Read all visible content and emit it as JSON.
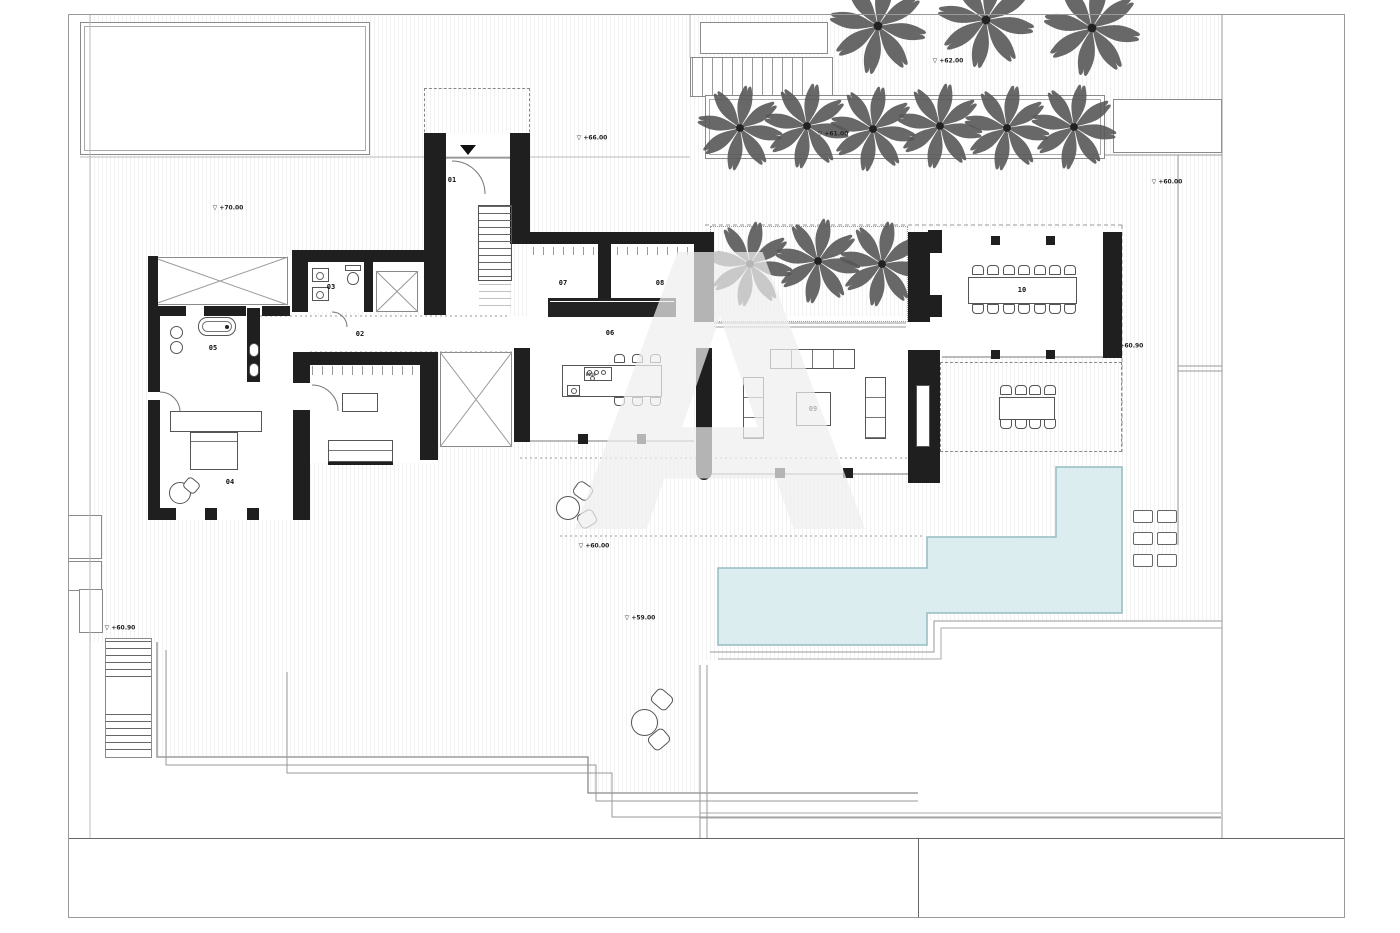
{
  "watermark": {
    "letter": "A"
  },
  "colors": {
    "wall": "#1f1f1f",
    "pool_fill": "#dbedef",
    "pool_edge": "#96bcc0",
    "line": "#8a8a8a"
  },
  "rooms": [
    {
      "number": "01",
      "area": "entry-stairs",
      "x": 452,
      "y": 180
    },
    {
      "number": "02",
      "area": "corridor",
      "x": 360,
      "y": 334
    },
    {
      "number": "03",
      "area": "wc",
      "x": 331,
      "y": 287
    },
    {
      "number": "04",
      "area": "bedroom",
      "x": 230,
      "y": 482
    },
    {
      "number": "05",
      "area": "bathroom",
      "x": 213,
      "y": 348
    },
    {
      "number": "06",
      "area": "kitchen",
      "x": 610,
      "y": 333
    },
    {
      "number": "07",
      "area": "storage-a",
      "x": 563,
      "y": 283
    },
    {
      "number": "08",
      "area": "storage-b",
      "x": 660,
      "y": 283
    },
    {
      "number": "09",
      "area": "living-room",
      "x": 813,
      "y": 409
    },
    {
      "number": "10",
      "area": "dining-room",
      "x": 1022,
      "y": 290
    }
  ],
  "elevation_markers": [
    {
      "text": "+70.00",
      "x": 228,
      "y": 208
    },
    {
      "text": "+66.00",
      "x": 592,
      "y": 138
    },
    {
      "text": "+62.00",
      "x": 948,
      "y": 61
    },
    {
      "text": "+61.00",
      "x": 833,
      "y": 134
    },
    {
      "text": "+60.00",
      "x": 1167,
      "y": 182
    },
    {
      "text": "+60.90",
      "x": 1128,
      "y": 346
    },
    {
      "text": "+60.00",
      "x": 594,
      "y": 546
    },
    {
      "text": "+59.00",
      "x": 640,
      "y": 618
    },
    {
      "text": "+60.90",
      "x": 120,
      "y": 628
    }
  ],
  "kitchen_island": {
    "label": "RO18"
  },
  "counts": {
    "dining_chairs": 14,
    "outdoor_dining_chairs": 8,
    "island_stools": 6,
    "sun_loungers": 6,
    "palms_top": 3,
    "palms_planter": 6,
    "palms_courtyard": 3,
    "bistro_tables": 2
  },
  "palms": {
    "top": [
      [
        878,
        26
      ],
      [
        986,
        20
      ],
      [
        1092,
        28
      ]
    ],
    "planter": [
      [
        740,
        128
      ],
      [
        807,
        126
      ],
      [
        873,
        129
      ],
      [
        940,
        126
      ],
      [
        1007,
        128
      ],
      [
        1074,
        127
      ]
    ],
    "courtyard": [
      [
        750,
        264
      ],
      [
        818,
        261
      ],
      [
        882,
        264
      ]
    ]
  },
  "loungers": [
    [
      1133,
      510
    ],
    [
      1133,
      532
    ],
    [
      1133,
      554
    ]
  ]
}
